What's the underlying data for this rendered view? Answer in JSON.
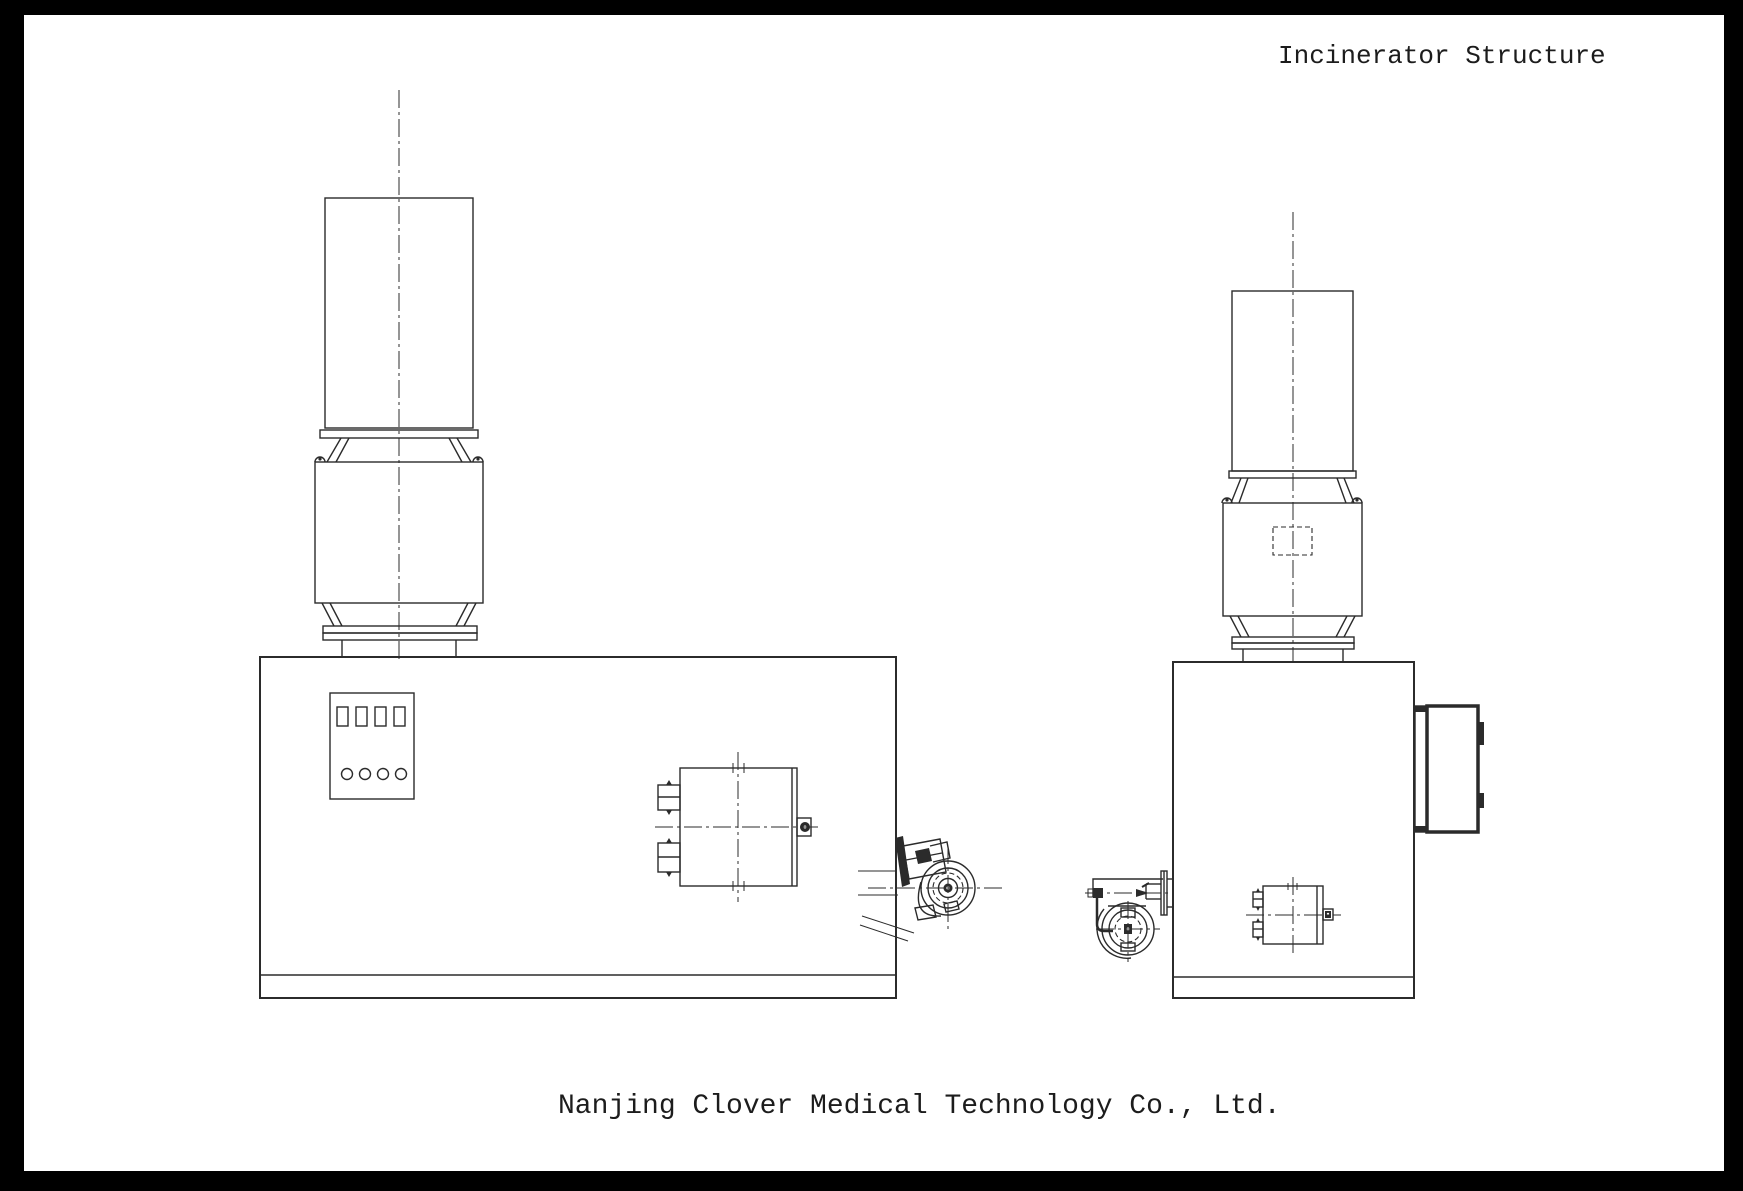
{
  "page": {
    "title": "Incinerator Structure",
    "footer": "Nanjing Clover Medical Technology Co., Ltd.",
    "background": "#ffffff",
    "frame_color": "#000000",
    "line_color": "#2b2b2b"
  },
  "drawing": {
    "type": "technical-line-drawing",
    "views": [
      {
        "id": "front-view",
        "components": [
          "chimney",
          "chimney-flange",
          "lifting-lugs",
          "secondary-combustion-chamber",
          "connection-flanges",
          "support-legs",
          "main-body",
          "control-panel",
          "charging-door",
          "door-latch",
          "burner-fan-assembly"
        ],
        "control_panel": {
          "square_switches": 4,
          "round_indicators": 4
        }
      },
      {
        "id": "side-view",
        "components": [
          "chimney",
          "chimney-flange",
          "lifting-lugs",
          "secondary-combustion-chamber",
          "inspection-port-dashed",
          "connection-flanges",
          "support-legs",
          "main-body",
          "side-door",
          "door-hinges",
          "oil-burner",
          "burner-port-box"
        ]
      }
    ]
  }
}
